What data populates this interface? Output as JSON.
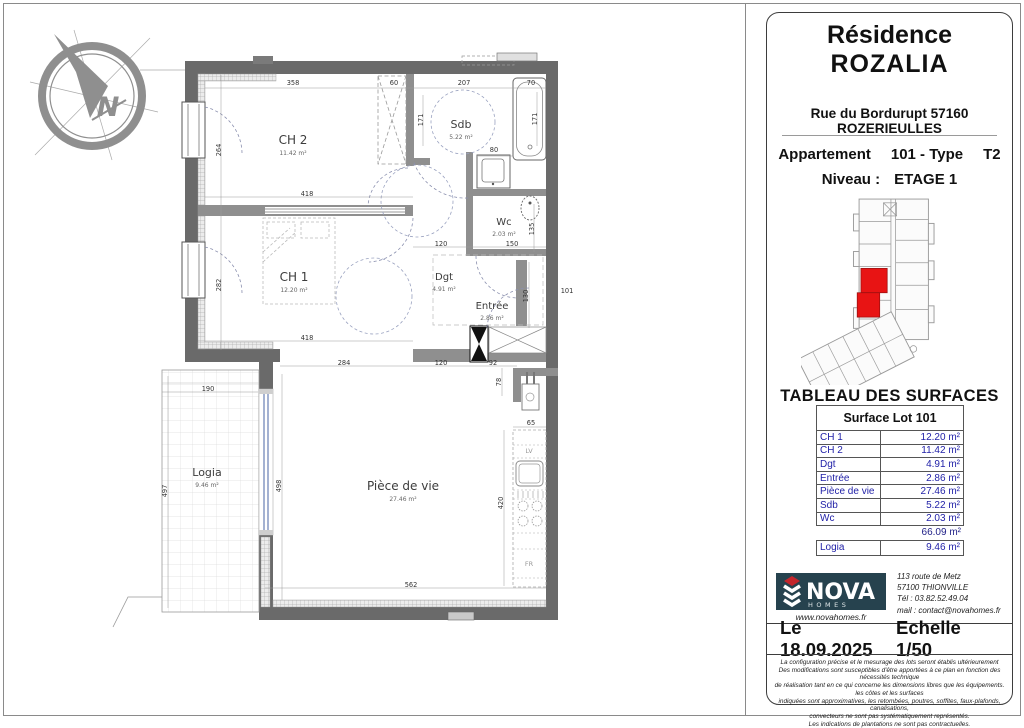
{
  "panel": {
    "residence_line1": "Résidence",
    "residence_line2": "ROZALIA",
    "address": "Rue du Bordurupt 57160 ROZERIEULLES",
    "apartment_label": "Appartement",
    "apartment_value": "101 - Type",
    "apartment_type": "T2",
    "level_label": "Niveau :",
    "level_value": "ETAGE 1",
    "surfaces_title": "TABLEAU DES SURFACES",
    "table": {
      "header": "Surface Lot 101",
      "rows": [
        {
          "label": "CH 1",
          "value": "12.20 m²"
        },
        {
          "label": "CH 2",
          "value": "11.42 m²"
        },
        {
          "label": "Dgt",
          "value": "4.91 m²"
        },
        {
          "label": "Entrée",
          "value": "2.86 m²"
        },
        {
          "label": "Pièce de vie",
          "value": "27.46 m²"
        },
        {
          "label": "Sdb",
          "value": "5.22 m²"
        },
        {
          "label": "Wc",
          "value": "2.03 m²"
        }
      ],
      "total": "66.09 m²",
      "logia_row": {
        "label": "Logia",
        "value": "9.46 m²"
      }
    },
    "nova": {
      "brand": "NOVA",
      "sub": "HOMES",
      "website": "www.novahomes.fr",
      "contact_lines": [
        "113 route de Metz",
        "57100 THIONVILLE",
        "Tél : 03.82.52.49.04",
        "mail : contact@novahomes.fr"
      ]
    },
    "footer": {
      "date": "Le 18.09.2025",
      "scale": "Echelle 1/50"
    },
    "disclaimer_lines": [
      "La configuration précise et le mesurage des lots seront établis ultérieurement",
      "Des modifications sont susceptibles d'être apportées à ce plan en fonction des nécessités technique",
      "de réalisation tant en ce qui concerne les dimensions libres que les équipements. les côtes et les surfaces",
      "indiquées sont approximatives, les retombées, poutres, soffites, faux-plafonds, canalisations,",
      "convecteurs ne sont pas systématiquement représentés.",
      "Les indications de plantations ne sont pas contractuelles."
    ]
  },
  "plan": {
    "unit_number": "101",
    "rooms": [
      {
        "name": "CH 2",
        "area": "11.42 m²",
        "x": 293,
        "y": 144,
        "s": 12
      },
      {
        "name": "CH 1",
        "area": "12.20 m²",
        "x": 294,
        "y": 281,
        "s": 12
      },
      {
        "name": "Sdb",
        "area": "5.22 m²",
        "x": 461,
        "y": 128,
        "s": 11
      },
      {
        "name": "Wc",
        "area": "2.03 m²",
        "x": 504,
        "y": 225,
        "s": 10
      },
      {
        "name": "Dgt",
        "area": "4.91 m²",
        "x": 444,
        "y": 280,
        "s": 10
      },
      {
        "name": "Entrée",
        "area": "2.86 m²",
        "x": 492,
        "y": 309,
        "s": 10
      },
      {
        "name": "Pièce de vie",
        "area": "27.46 m²",
        "x": 403,
        "y": 490,
        "s": 12
      },
      {
        "name": "Logia",
        "area": "9.46 m²",
        "x": 207,
        "y": 476,
        "s": 11,
        "c": "#8a8a8a"
      }
    ],
    "dims": [
      {
        "t": "358",
        "x": 293,
        "y": 85
      },
      {
        "t": "60",
        "x": 394,
        "y": 85
      },
      {
        "t": "207",
        "x": 464,
        "y": 85
      },
      {
        "t": "70",
        "x": 531,
        "y": 85
      },
      {
        "t": "264",
        "x": 221,
        "y": 150,
        "r": -90
      },
      {
        "t": "171",
        "x": 423,
        "y": 120,
        "r": -90
      },
      {
        "t": "171",
        "x": 537,
        "y": 119,
        "r": -90
      },
      {
        "t": "80",
        "x": 494,
        "y": 152
      },
      {
        "t": "418",
        "x": 307,
        "y": 196
      },
      {
        "t": "418",
        "x": 307,
        "y": 340
      },
      {
        "t": "282",
        "x": 221,
        "y": 285,
        "r": -90
      },
      {
        "t": "135",
        "x": 534,
        "y": 229,
        "r": -90
      },
      {
        "t": "120",
        "x": 441,
        "y": 246
      },
      {
        "t": "150",
        "x": 512,
        "y": 246
      },
      {
        "t": "130",
        "x": 528,
        "y": 296,
        "r": -90
      },
      {
        "t": "101",
        "x": 567,
        "y": 293
      },
      {
        "t": "284",
        "x": 344,
        "y": 365
      },
      {
        "t": "120",
        "x": 441,
        "y": 365
      },
      {
        "t": "92",
        "x": 493,
        "y": 365
      },
      {
        "t": "78",
        "x": 501,
        "y": 382,
        "r": -90
      },
      {
        "t": "65",
        "x": 531,
        "y": 425
      },
      {
        "t": "420",
        "x": 503,
        "y": 503,
        "r": -90
      },
      {
        "t": "190",
        "x": 208,
        "y": 391
      },
      {
        "t": "497",
        "x": 167,
        "y": 491,
        "r": -90
      },
      {
        "t": "498",
        "x": 281,
        "y": 486,
        "r": -90
      },
      {
        "t": "562",
        "x": 411,
        "y": 587
      }
    ],
    "appliance_labels": [
      {
        "t": "LV",
        "x": 529,
        "y": 453
      },
      {
        "t": "FR",
        "x": 529,
        "y": 566
      }
    ]
  },
  "compass": {
    "north_label": "N"
  },
  "colors": {
    "accent_red": "#e81414",
    "table_blue": "#2222a8",
    "nova_bg": "#26424e",
    "nova_red": "#c4262c",
    "wall_gray": "#6a6a6a"
  }
}
